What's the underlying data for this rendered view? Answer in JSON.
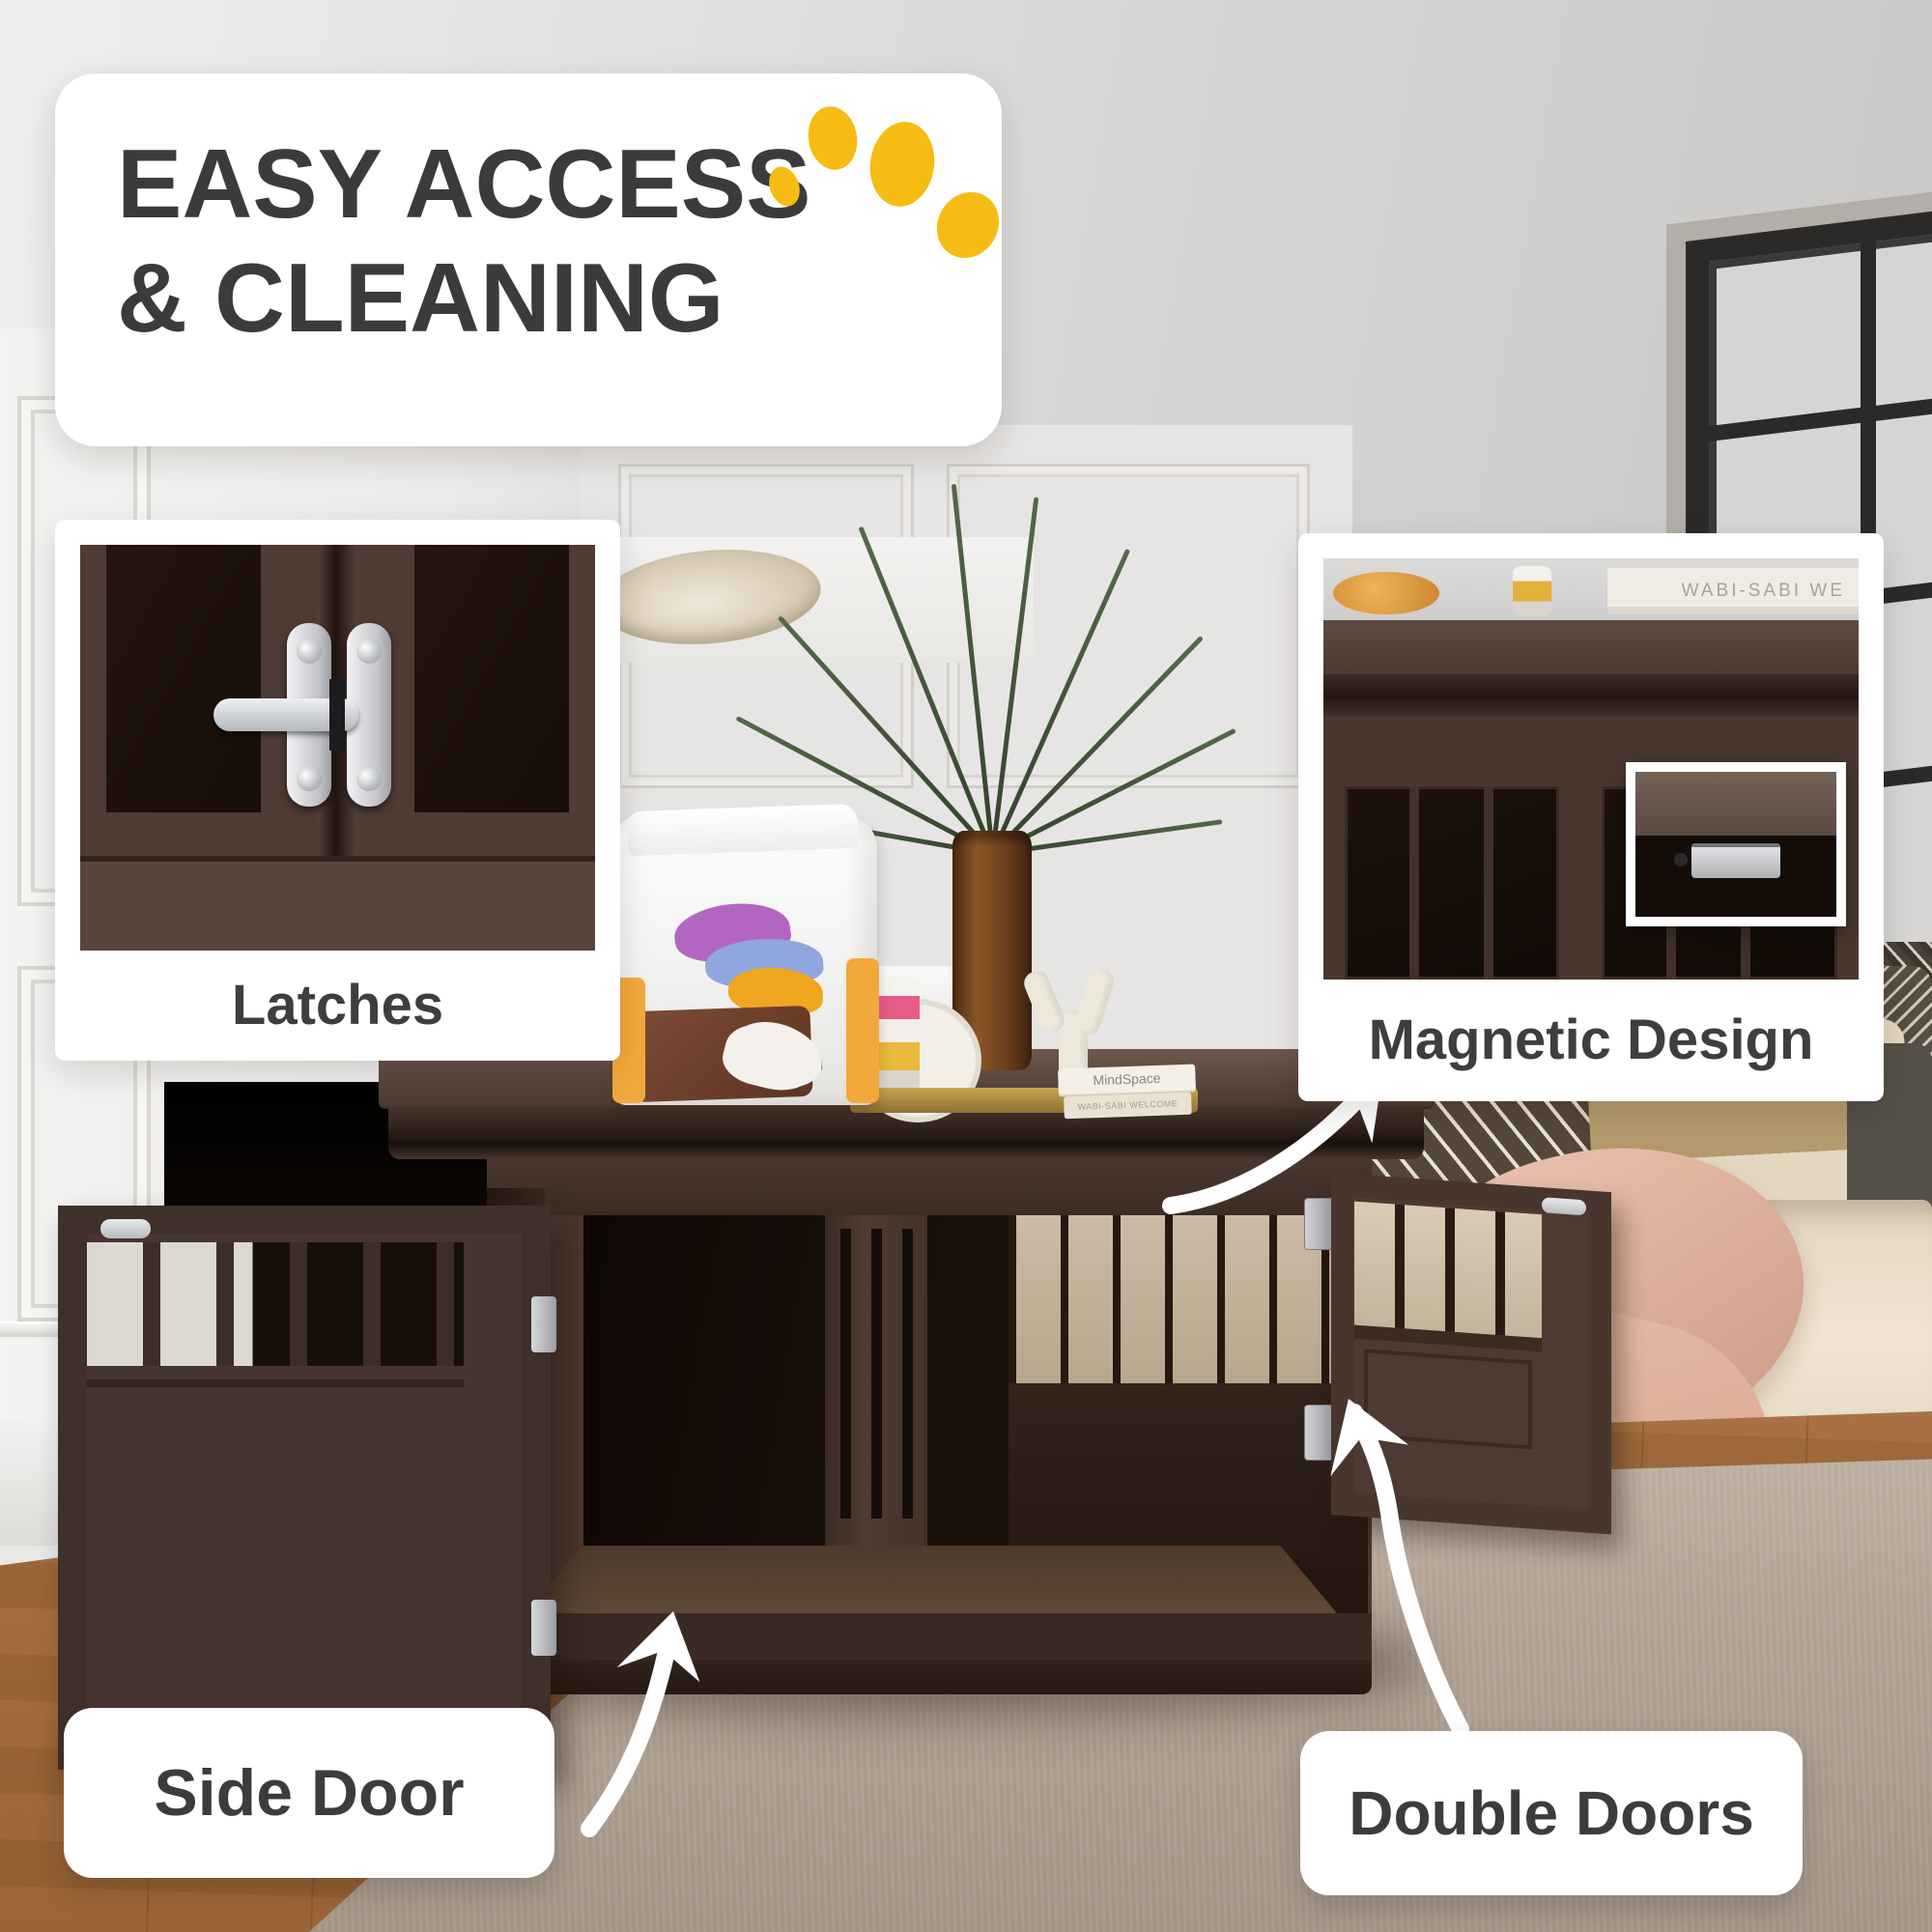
{
  "title": {
    "line1": "EASY ACCESS",
    "line2": "& CLEANING"
  },
  "callouts": {
    "latches": {
      "label": "Latches"
    },
    "magnetic_design": {
      "label": "Magnetic Design",
      "book_spine_text": "WABI-SABI WE"
    },
    "side_door": {
      "label": "Side Door"
    },
    "double_doors": {
      "label": "Double Doors"
    }
  },
  "crate_top_items": {
    "book_stack": {
      "top_book": "MindSpace",
      "bottom_book": "WABI-SABI WELCOME"
    },
    "dog_food_bag": {
      "tagline": "New generation of natural"
    }
  },
  "icons": {
    "paw": "paw-print-icon",
    "arrows": "curved-arrow-icon"
  },
  "colors": {
    "paw_yellow": "#F6BC13",
    "title_text": "#3B3B3D",
    "label_text": "#3E3E40",
    "crate_brown": "#4A372F",
    "arrow_white": "#FFFFFF",
    "sofa_cream": "#EFE5D2",
    "throw_pink": "#E0B29E"
  }
}
